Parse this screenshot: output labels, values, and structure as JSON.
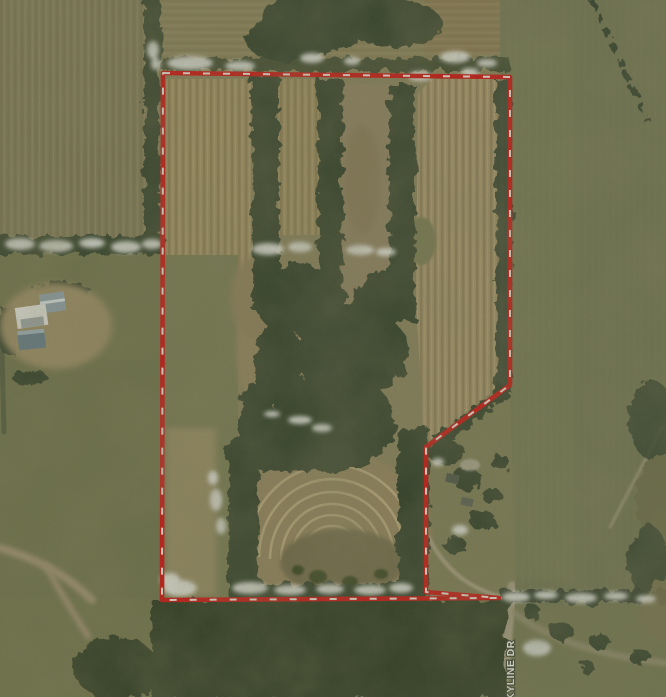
{
  "map": {
    "type": "aerial-imagery",
    "road_label": "SKYLINE DR"
  },
  "boundary": {
    "points": "163,73 510,77 510,385 426,447 426,592 499,598 162,600",
    "description": "red dashed parcel outline"
  },
  "colors": {
    "boundary_red": "#d20a0a",
    "boundary_dash": "#f5f3ee",
    "label_fill": "#f4f4f0",
    "label_outline": "#39422f"
  }
}
